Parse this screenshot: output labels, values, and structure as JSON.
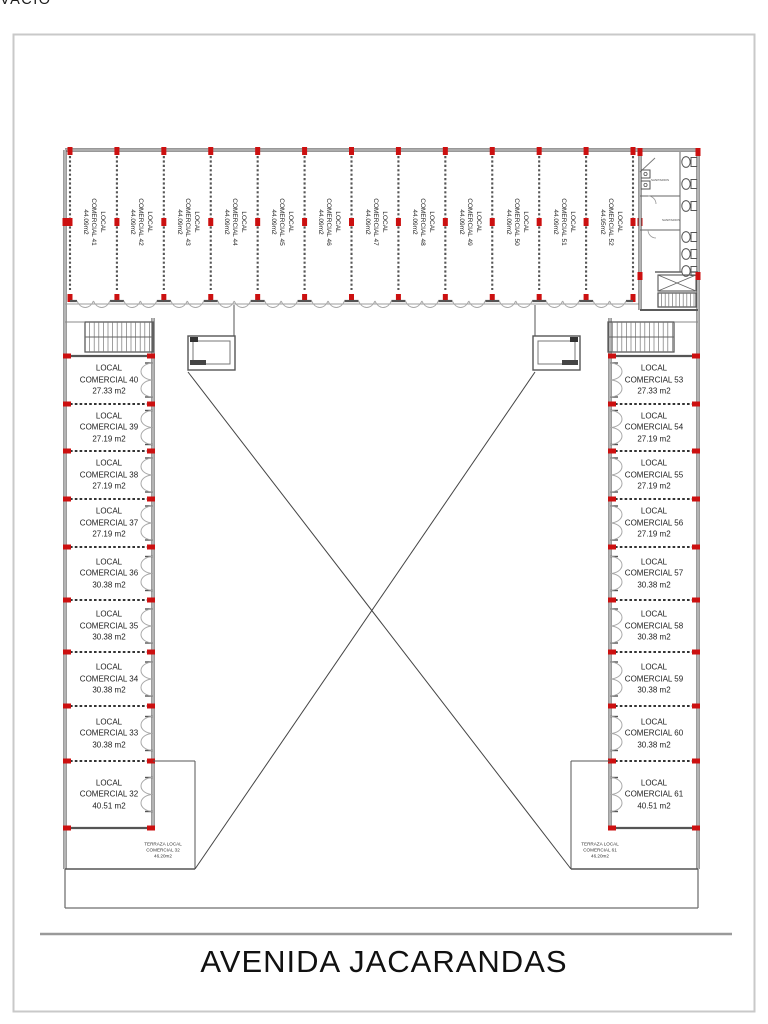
{
  "document": {
    "street_label": "AVENIDA JACARANDAS",
    "void_label": "VACIO"
  },
  "top_row_units": [
    {
      "line1": "LOCAL",
      "line2": "COMERCIAL 41",
      "area": "44.09m2"
    },
    {
      "line1": "LOCAL",
      "line2": "COMERCIAL 42",
      "area": "44.09m2"
    },
    {
      "line1": "LOCAL",
      "line2": "COMERCIAL 43",
      "area": "44.09m2"
    },
    {
      "line1": "LOCAL",
      "line2": "COMERCIAL 44",
      "area": "44.09m2"
    },
    {
      "line1": "LOCAL",
      "line2": "COMERCIAL 45",
      "area": "44.09m2"
    },
    {
      "line1": "LOCAL",
      "line2": "COMERCIAL 46",
      "area": "44.09m2"
    },
    {
      "line1": "LOCAL",
      "line2": "COMERCIAL 47",
      "area": "44.09m2"
    },
    {
      "line1": "LOCAL",
      "line2": "COMERCIAL 48",
      "area": "44.09m2"
    },
    {
      "line1": "LOCAL",
      "line2": "COMERCIAL 49",
      "area": "44.09m2"
    },
    {
      "line1": "LOCAL",
      "line2": "COMERCIAL 50",
      "area": "44.09m2"
    },
    {
      "line1": "LOCAL",
      "line2": "COMERCIAL 51",
      "area": "44.09m2"
    },
    {
      "line1": "LOCAL",
      "line2": "COMERCIAL 52",
      "area": "44.95m2"
    }
  ],
  "left_wing_units": [
    {
      "line1": "LOCAL",
      "line2": "COMERCIAL 40",
      "area": "27.33 m2"
    },
    {
      "line1": "LOCAL",
      "line2": "COMERCIAL 39",
      "area": "27.19 m2"
    },
    {
      "line1": "LOCAL",
      "line2": "COMERCIAL 38",
      "area": "27.19 m2"
    },
    {
      "line1": "LOCAL",
      "line2": "COMERCIAL 37",
      "area": "27.19 m2"
    },
    {
      "line1": "LOCAL",
      "line2": "COMERCIAL 36",
      "area": "30.38 m2"
    },
    {
      "line1": "LOCAL",
      "line2": "COMERCIAL 35",
      "area": "30.38 m2"
    },
    {
      "line1": "LOCAL",
      "line2": "COMERCIAL 34",
      "area": "30.38 m2"
    },
    {
      "line1": "LOCAL",
      "line2": "COMERCIAL 33",
      "area": "30.38 m2"
    },
    {
      "line1": "LOCAL",
      "line2": "COMERCIAL 32",
      "area": "40.51 m2"
    }
  ],
  "right_wing_units": [
    {
      "line1": "LOCAL",
      "line2": "COMERCIAL 53",
      "area": "27.33 m2"
    },
    {
      "line1": "LOCAL",
      "line2": "COMERCIAL 54",
      "area": "27.19 m2"
    },
    {
      "line1": "LOCAL",
      "line2": "COMERCIAL 55",
      "area": "27.19 m2"
    },
    {
      "line1": "LOCAL",
      "line2": "COMERCIAL 56",
      "area": "27.19 m2"
    },
    {
      "line1": "LOCAL",
      "line2": "COMERCIAL 57",
      "area": "30.38 m2"
    },
    {
      "line1": "LOCAL",
      "line2": "COMERCIAL 58",
      "area": "30.38 m2"
    },
    {
      "line1": "LOCAL",
      "line2": "COMERCIAL 59",
      "area": "30.38 m2"
    },
    {
      "line1": "LOCAL",
      "line2": "COMERCIAL 60",
      "area": "30.38 m2"
    },
    {
      "line1": "LOCAL",
      "line2": "COMERCIAL 61",
      "area": "40.51 m2"
    }
  ],
  "terraces": {
    "left": {
      "line1": "TERRAZA LOCAL",
      "line2": "COMERCIAL 32",
      "line3": "46.20m2"
    },
    "right": {
      "line1": "TERRAZA LOCAL",
      "line2": "COMERCIAL 61",
      "line3": "46.20m2"
    }
  },
  "restrooms": {
    "label_top": "SANITARIOS",
    "label_bottom": "SANITARIOS"
  },
  "colors": {
    "column_marker": "#cc1010",
    "wall": "#5a5a5a",
    "thin_line": "#4a4a4a",
    "door_arc": "#a8a8a8",
    "frame": "#c9c9c9",
    "street_line": "#9a9a9a"
  }
}
